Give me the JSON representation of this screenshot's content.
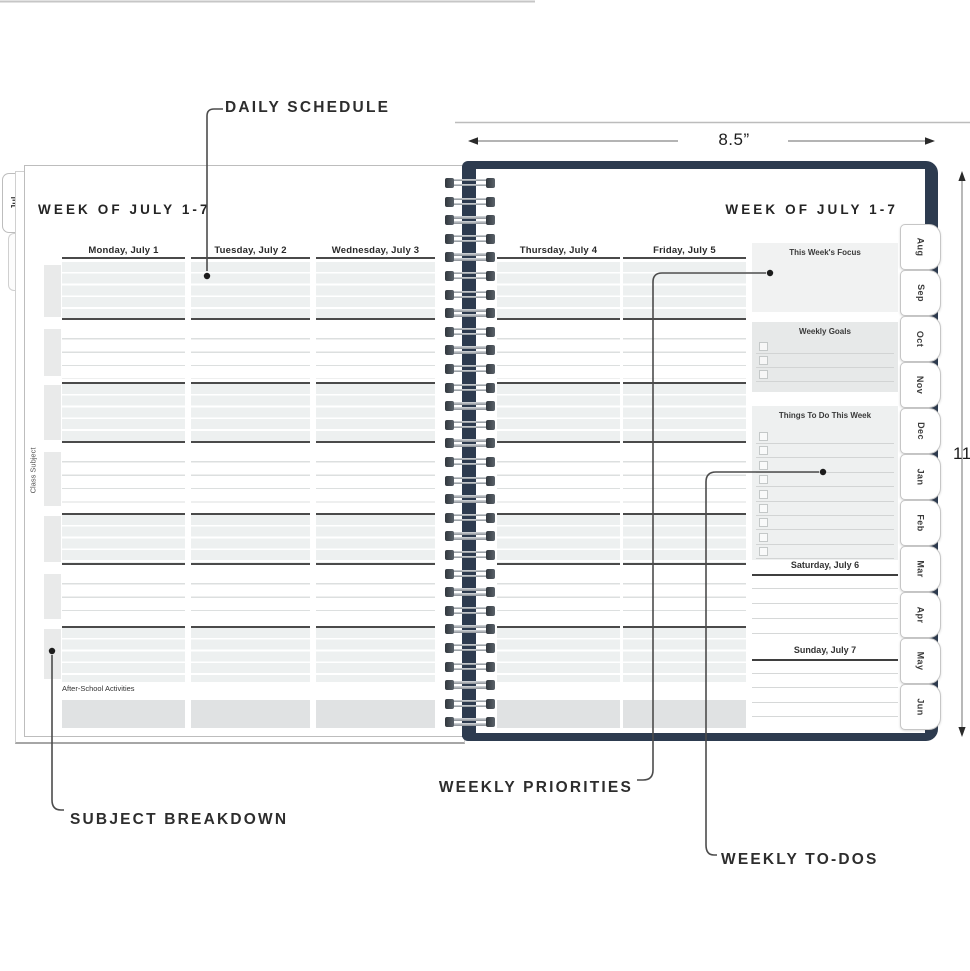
{
  "annotations": {
    "daily_schedule": "DAILY SCHEDULE",
    "subject_breakdown": "SUBJECT BREAKDOWN",
    "weekly_priorities": "WEEKLY PRIORITIES",
    "weekly_todos": "WEEKLY TO-DOS"
  },
  "dimensions": {
    "width_label": "8.5”",
    "height_label": "11”"
  },
  "left_page": {
    "edge_tab": "Jul",
    "title": "WEEK OF JULY 1-7",
    "margin_label": "Class Subject",
    "after_school_label": "After-School Activities",
    "days": [
      "Monday, July 1",
      "Tuesday, July 2",
      "Wednesday, July 3"
    ]
  },
  "right_page": {
    "title": "WEEK OF JULY 1-7",
    "days": [
      "Thursday, July 4",
      "Friday, July 5"
    ],
    "sidebar": {
      "focus_title": "This Week's Focus",
      "goals_title": "Weekly Goals",
      "goals_checkbox_rows": 3,
      "todos_title": "Things To Do This Week",
      "todos_checkbox_rows": 9,
      "saturday_title": "Saturday, July 6",
      "sunday_title": "Sunday, July 7",
      "weekend_ruled_lines": 4
    },
    "month_tabs": [
      "Aug",
      "Sep",
      "Oct",
      "Nov",
      "Dec",
      "Jan",
      "Feb",
      "Mar",
      "Apr",
      "May",
      "Jun"
    ]
  },
  "grid": {
    "section_pattern": [
      "shaded",
      "lined",
      "shaded",
      "lined",
      "shaded",
      "lined",
      "shaded"
    ],
    "spiral_loops": 30
  },
  "colors": {
    "cover_navy": "#2d3b4f",
    "shaded_row": "#edf0f0",
    "dark_block": "#e0e2e3",
    "rule_dark": "#4a4a4a"
  }
}
